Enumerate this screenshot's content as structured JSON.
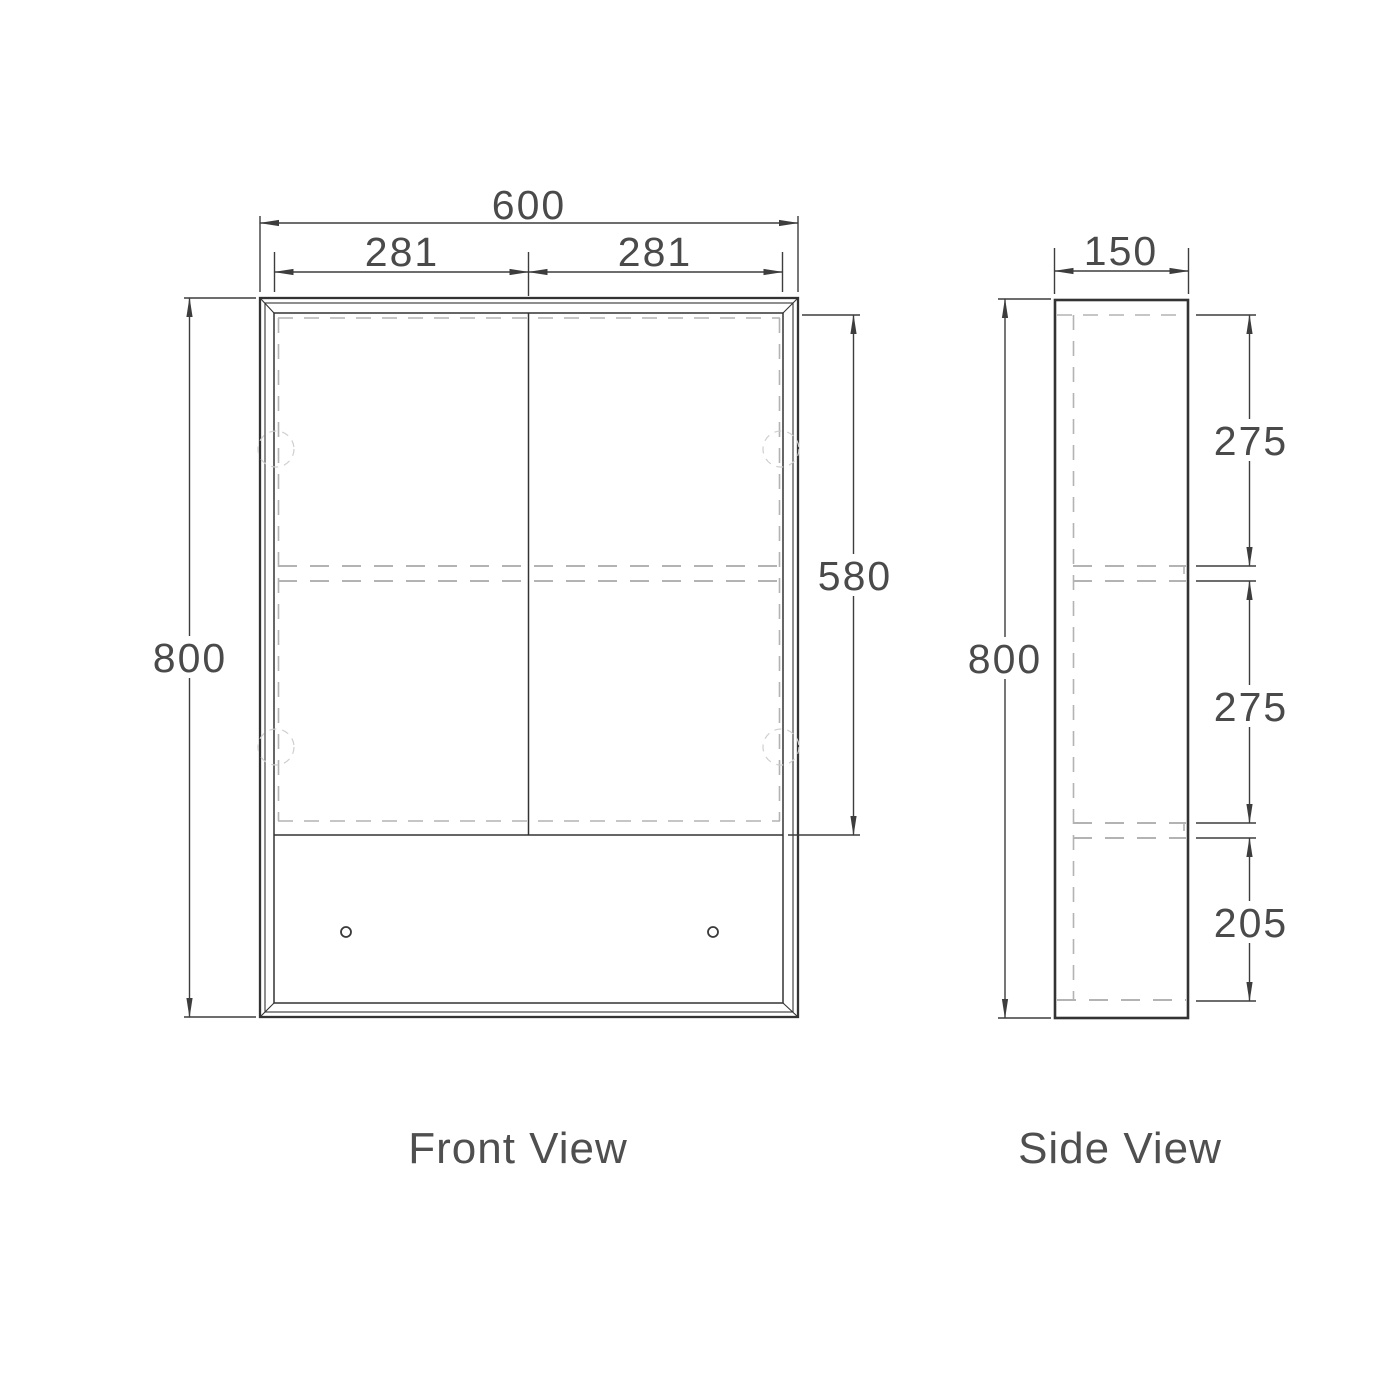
{
  "front_view": {
    "title": "Front View",
    "dims": {
      "overall_width": "600",
      "left_door_width": "281",
      "right_door_width": "281",
      "overall_height": "800",
      "door_height": "580"
    }
  },
  "side_view": {
    "title": "Side View",
    "dims": {
      "depth": "150",
      "overall_height": "800",
      "top_section": "275",
      "middle_section": "275",
      "bottom_section": "205"
    }
  },
  "colors": {
    "background": "#ffffff",
    "solid_line": "#333333",
    "dimension_line": "#3d3d3d",
    "hidden_line": "#b3b3b3",
    "hinge_line": "#cfcfcf",
    "text": "#4a4a4a"
  }
}
